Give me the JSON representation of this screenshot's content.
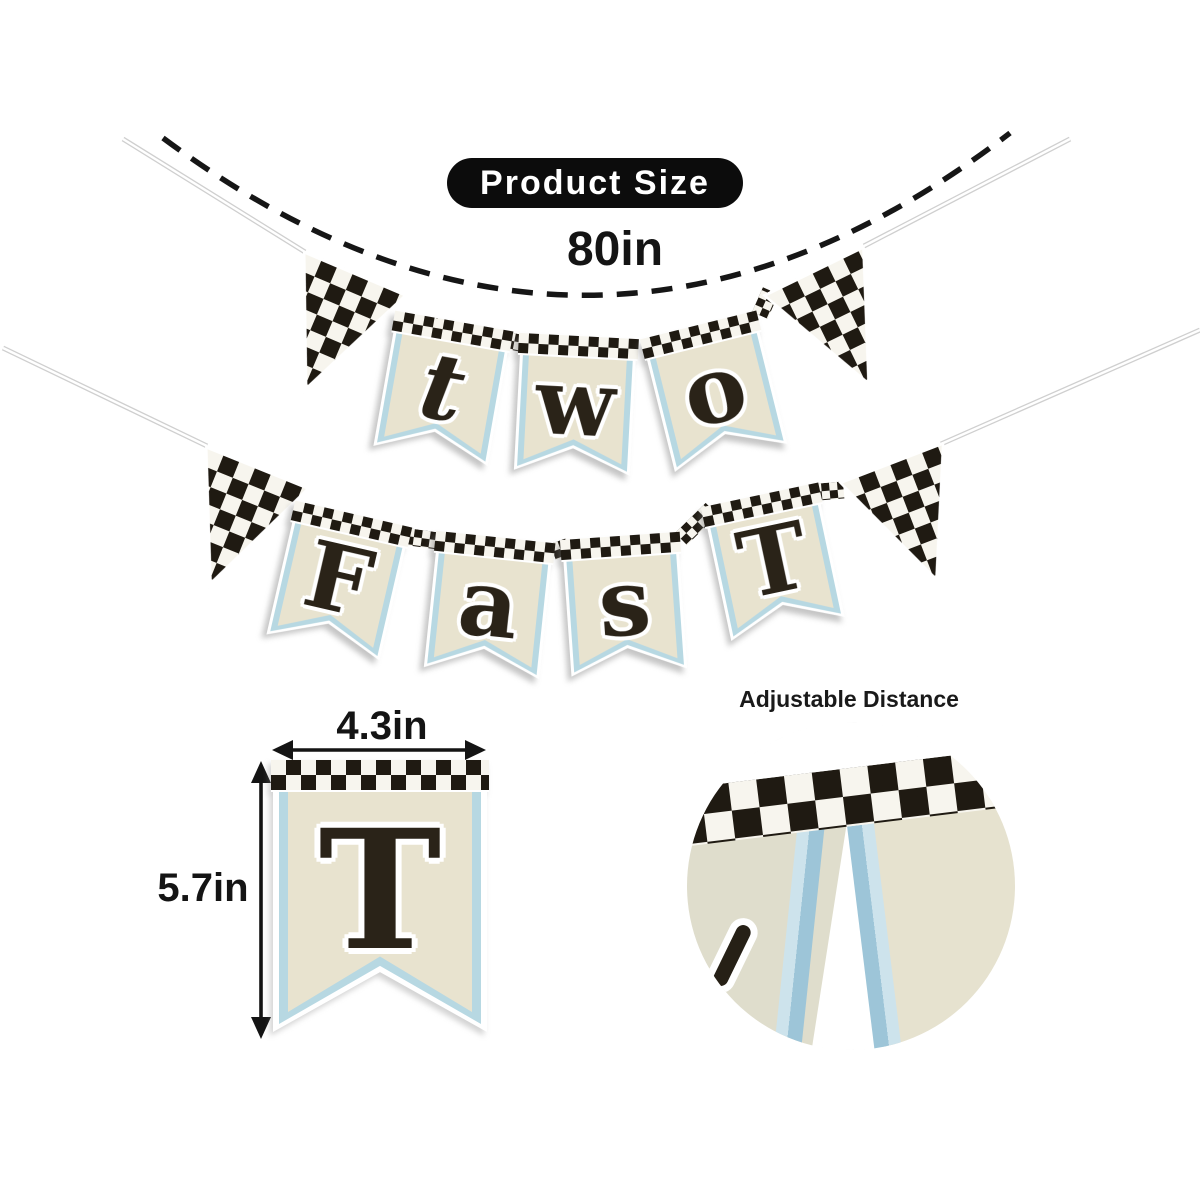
{
  "header": {
    "badge_label": "Product Size",
    "banner_length": "80in"
  },
  "banner": {
    "rows": [
      {
        "letters": [
          "t",
          "w",
          "o"
        ]
      },
      {
        "letters": [
          "F",
          "a",
          "s",
          "T"
        ]
      }
    ]
  },
  "dimension_flag": {
    "letter": "T",
    "width_label": "4.3in",
    "height_label": "5.7in"
  },
  "detail_view": {
    "label": "Adjustable Distance"
  },
  "colors": {
    "check_dark": "#1f1a12",
    "check_light": "#f7f5ee",
    "flag_cream": "#e8e3cf",
    "flag_blue": "#b7d8e2",
    "detail_blue": "#9dc5d8",
    "string_gray": "#cfcfcf",
    "ink": "#141414"
  }
}
